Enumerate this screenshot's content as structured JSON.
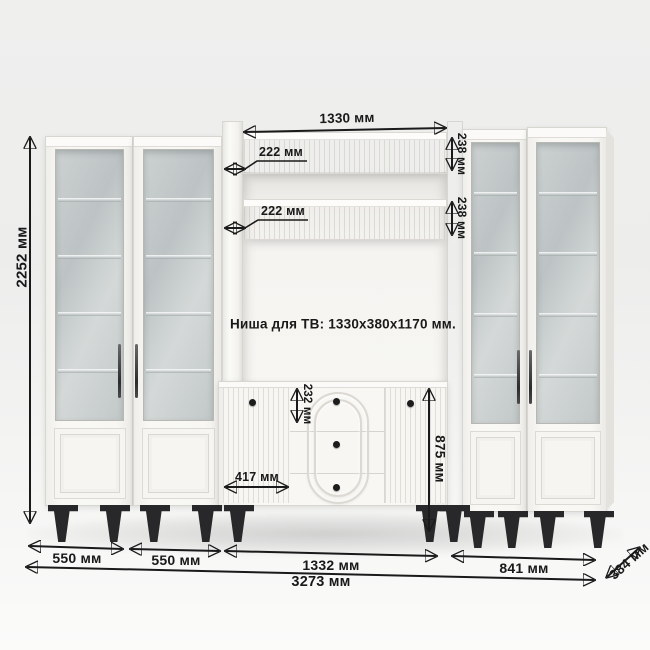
{
  "scene": {
    "type": "furniture-dimension-diagram"
  },
  "labels": {
    "total_height": "2252 мм",
    "shelf_length": "1330 мм",
    "shelf_depth_upper": "222 мм",
    "shelf_depth_lower": "222 мм",
    "shelf_face_upper": "238 мм",
    "shelf_face_lower": "238 мм",
    "tv_niche": "Ниша для ТВ: 1330х380х1170 мм.",
    "drawer_height": "232 мм",
    "door_width": "417 мм",
    "stand_height": "875 мм",
    "width_cabinet_1": "550 мм",
    "width_cabinet_2": "550 мм",
    "width_center": "1332 мм",
    "width_right": "841 мм",
    "width_total": "3273 мм",
    "depth": "384 мм"
  },
  "colors": {
    "annotation": "#1a1a1a",
    "furniture_body": "#f8f7f4",
    "glass": "#c5cbcb",
    "legs": "#28282a",
    "background": "#efefee"
  }
}
